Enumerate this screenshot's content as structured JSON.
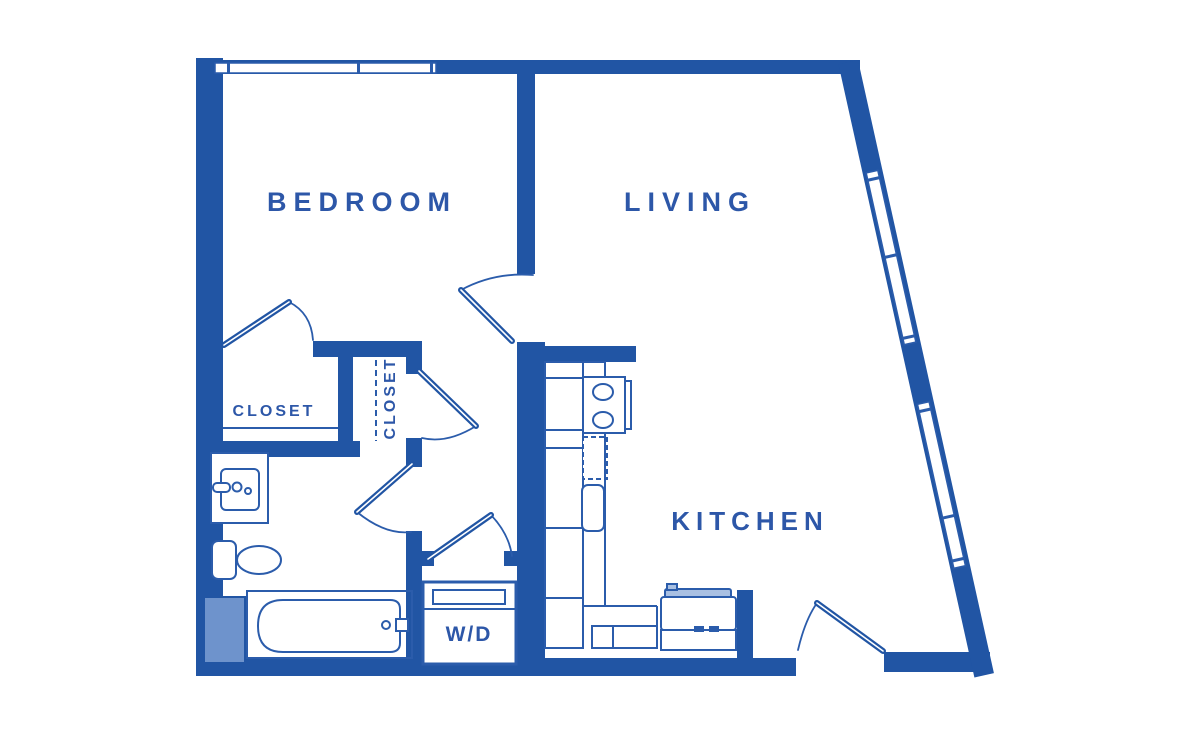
{
  "plan": {
    "type": "apartment-floor-plan",
    "colors": {
      "wall": "#2155a4",
      "line": "#2b5cab",
      "label_text": "#2d57a8",
      "accent_fill": "#6e93cc"
    },
    "rooms": {
      "bedroom": {
        "label": "BEDROOM"
      },
      "living": {
        "label": "LIVING"
      },
      "kitchen": {
        "label": "KITCHEN"
      },
      "closet_left": {
        "label": "CLOSET"
      },
      "closet_right": {
        "label": "CLOSET"
      },
      "laundry": {
        "label": "W/D"
      }
    },
    "fixtures": {
      "bathroom": [
        "sink",
        "toilet",
        "bathtub",
        "shower-shelf"
      ],
      "kitchen": [
        "kitchen-sink",
        "dishwasher",
        "cabinets",
        "range"
      ],
      "laundry": [
        "washer-dryer"
      ]
    },
    "openings": {
      "doors": [
        "bedroom-door",
        "closet-left-door",
        "closet-right-door",
        "bathroom-door",
        "laundry-door",
        "entry-door"
      ],
      "windows": [
        "bedroom-top-window",
        "living-slant-window-upper",
        "living-slant-window-lower"
      ]
    }
  }
}
